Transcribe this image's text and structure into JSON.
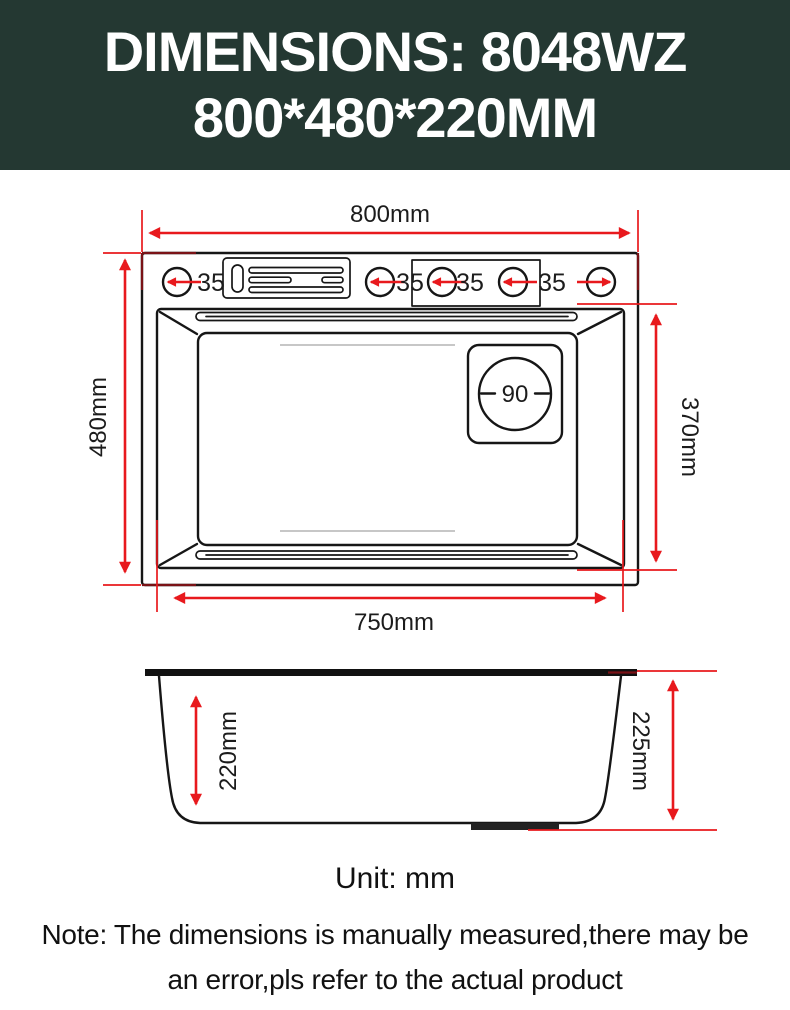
{
  "header": {
    "line1": "DIMENSIONS: 8048WZ",
    "line2": "800*480*220MM"
  },
  "colors": {
    "header_bg": "#243832",
    "header_text": "#ffffff",
    "dimension_red": "#e8191d",
    "overlap_dark_red": "#7a1216",
    "drawing_black": "#161616"
  },
  "top_view": {
    "overall_width_label": "800mm",
    "overall_depth_label": "480mm",
    "inner_width_label": "750mm",
    "inner_depth_label": "370mm",
    "hole_labels": [
      "35",
      "35",
      "35",
      "35"
    ],
    "drain_label": "90"
  },
  "side_view": {
    "inner_depth_label": "220mm",
    "overall_height_label": "225mm"
  },
  "footer": {
    "unit_label": "Unit: mm",
    "note_line1": "Note: The dimensions is manually measured,there may be",
    "note_line2": "an error,pls refer to the actual product"
  }
}
